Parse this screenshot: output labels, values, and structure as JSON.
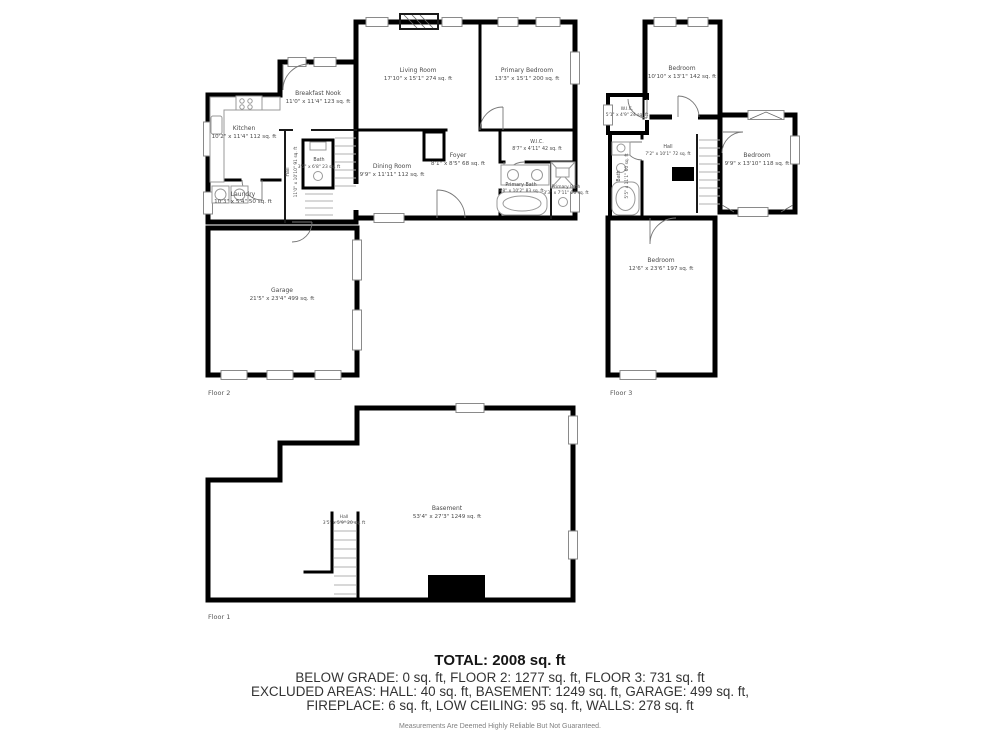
{
  "floors": [
    {
      "label": "Floor 2",
      "rooms": [
        {
          "name": "Living Room",
          "dims": "17'10\" x 15'1\" 274 sq. ft"
        },
        {
          "name": "Primary Bedroom",
          "dims": "13'3\" x 15'1\" 200 sq. ft"
        },
        {
          "name": "Breakfast Nook",
          "dims": "11'0\" x 11'4\" 123 sq. ft"
        },
        {
          "name": "Kitchen",
          "dims": "10'2\" x 11'4\" 112 sq. ft"
        },
        {
          "name": "Dining Room",
          "dims": "9'9\" x 11'11\" 112 sq. ft"
        },
        {
          "name": "Foyer",
          "dims": "8'1\" x 8'5\" 68 sq. ft"
        },
        {
          "name": "W.I.C.",
          "dims": "8'7\" x 4'11\" 42 sq. ft"
        },
        {
          "name": "Bath",
          "dims": "3'5\" x 6'8\" 23 sq. ft"
        },
        {
          "name": "Hall",
          "dims": "11'0\" x 10'10\" 91 sq. ft"
        },
        {
          "name": "Laundry",
          "dims": "10'3\" x 5'4\" 50 sq. ft"
        },
        {
          "name": "Primary Bath",
          "dims": "9'8\" x 10'2\" 83 sq. ft"
        },
        {
          "name": "Primary Bath",
          "dims": "3'3\" x 7'11\" 26 sq. ft"
        },
        {
          "name": "Garage",
          "dims": "21'5\" x 23'4\" 499 sq. ft"
        }
      ]
    },
    {
      "label": "Floor 3",
      "rooms": [
        {
          "name": "Bedroom",
          "dims": "10'10\" x 13'1\" 142 sq. ft"
        },
        {
          "name": "W.I.C.",
          "dims": "5'1\" x 4'9\" 24 sq. ft"
        },
        {
          "name": "Hall",
          "dims": "7'2\" x 10'1\" 72 sq. ft"
        },
        {
          "name": "Bath",
          "dims": "5'5\" x 11'1\" 60 sq. ft"
        },
        {
          "name": "Bedroom",
          "dims": "9'9\" x 13'10\" 118 sq. ft"
        },
        {
          "name": "Bedroom",
          "dims": "12'6\" x 23'6\" 197 sq. ft"
        }
      ]
    },
    {
      "label": "Floor 1",
      "rooms": [
        {
          "name": "Basement",
          "dims": "53'4\" x 27'3\" 1249 sq. ft"
        },
        {
          "name": "Hall",
          "dims": "3'5\" x 5'9\" 20 sq. ft"
        }
      ]
    }
  ],
  "summary": {
    "total": "TOTAL: 2008 sq. ft",
    "line1": "BELOW GRADE: 0 sq. ft, FLOOR 2: 1277 sq. ft, FLOOR 3: 731 sq. ft",
    "line2": "EXCLUDED AREAS: HALL: 40 sq. ft, BASEMENT: 1249 sq. ft, GARAGE: 499 sq. ft,",
    "line3": "FIREPLACE: 6 sq. ft, LOW CEILING: 95 sq. ft, WALLS: 278 sq. ft",
    "disclaimer": "Measurements Are Deemed Highly Reliable But Not Guaranteed."
  },
  "colors": {
    "wall": "#000000",
    "label": "#4a4a4a"
  }
}
